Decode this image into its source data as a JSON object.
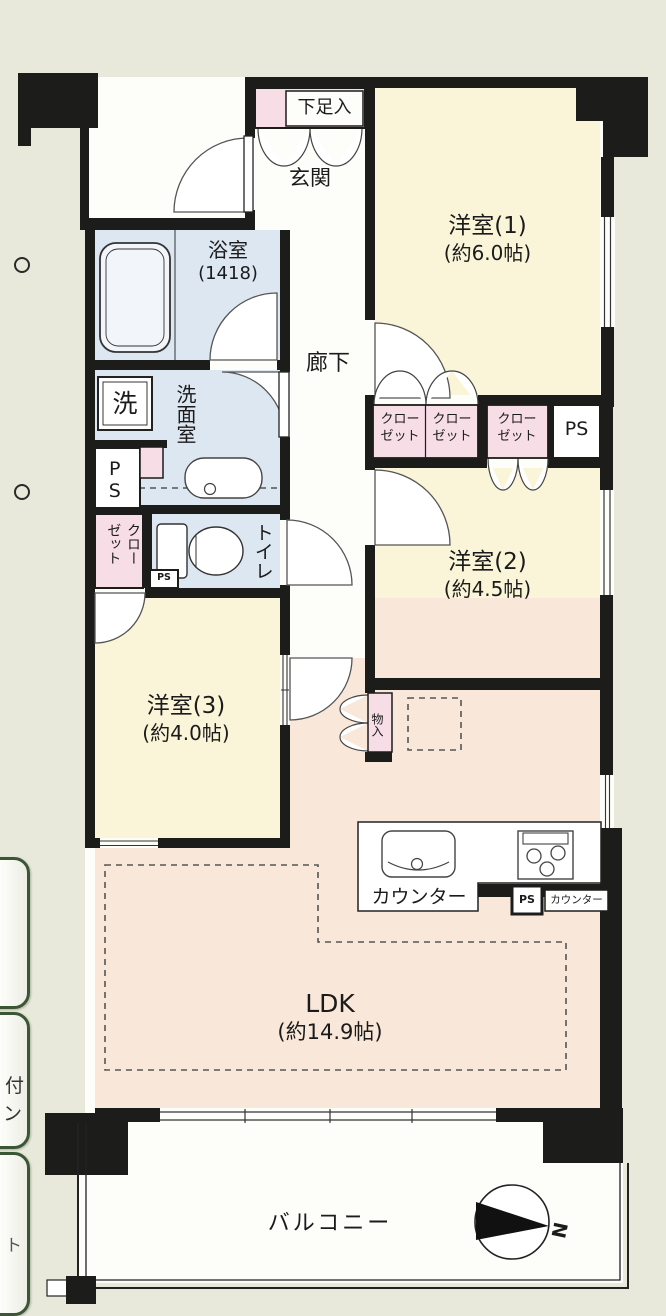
{
  "floorplan": {
    "shoe": "下足入",
    "genkan": "玄関",
    "bath_name": "浴室",
    "bath_size": "(1418)",
    "corridor": "廊下",
    "washroom": "洗面室",
    "washer": "洗",
    "ps_wash": "PS",
    "closet_wash": "クローゼット",
    "toilet": "トイレ",
    "toilet_ps": "PS",
    "w1_name": "洋室(1)",
    "w1_size": "(約6.0帖)",
    "w2_name": "洋室(2)",
    "w2_size": "(約4.5帖)",
    "w3_name": "洋室(3)",
    "w3_size": "(約4.0帖)",
    "closet_a": "クローゼット",
    "closet_b": "クローゼット",
    "closet_c": "クローゼット",
    "ps_top": "PS",
    "storage": "物入",
    "ldk_name": "LDK",
    "ldk_size": "(約14.9帖)",
    "counter": "カウンター",
    "counter_small": "カウンター",
    "kitchen_ps": "PS",
    "balcony": "バルコニー",
    "north": "N"
  },
  "sidebar": {
    "b2_top": "付",
    "b2_bottom": "ン",
    "b3_frag": "ト"
  },
  "colors": {
    "background": "#e8e9da",
    "wall": "#1c1c1a",
    "western_room": "#faf5d8",
    "ldk": "#f9e8da",
    "wet_room": "#dde7f1",
    "closet_pink": "#f7dde6",
    "white_room": "#fdfdfa",
    "button_border": "#3a5634"
  }
}
